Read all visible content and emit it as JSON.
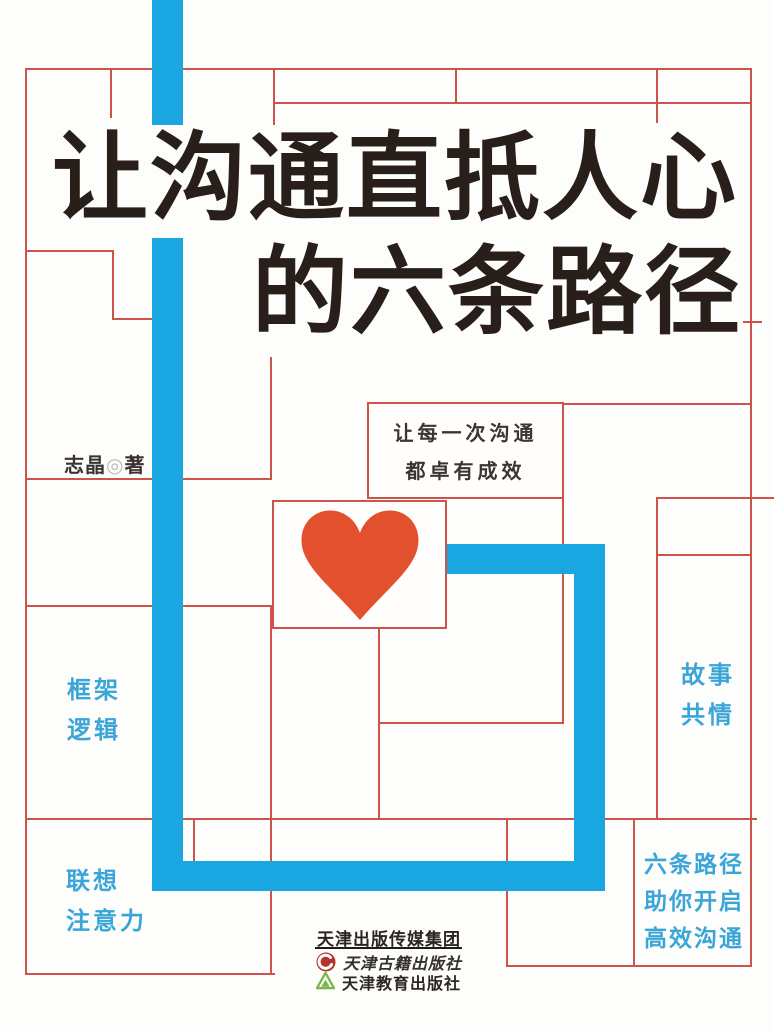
{
  "book_cover": {
    "title": {
      "line1": "让沟通直抵人心",
      "line2": "的六条路径"
    },
    "author": {
      "name": "志晶",
      "mark": "◎",
      "role": "著"
    },
    "tagline": {
      "line1": "让每一次沟通",
      "line2": "都卓有成效"
    },
    "keywords": {
      "frame": "框架",
      "logic": "逻辑",
      "story": "故事",
      "empathy": "共情",
      "association": "联想",
      "attention": "注意力",
      "promo_line1": "六条路径",
      "promo_line2": "助你开启",
      "promo_line3": "高效沟通"
    },
    "publisher": {
      "group": "天津出版传媒集团",
      "imprint_classics": "天津古籍出版社",
      "imprint_education": "天津教育出版社"
    },
    "icons": {
      "heart": "heart-icon",
      "imprint_classics_logo": "red-swirl-logo-icon",
      "imprint_education_logo": "green-triangle-logo-icon"
    },
    "colors": {
      "path_blue": "#1aa7e1",
      "grid_red": "#cd544a",
      "heart_red": "#e2502d",
      "keyword_blue": "#3aa5d9",
      "title_ink": "#281f1a",
      "background": "#fdfdfb"
    }
  }
}
